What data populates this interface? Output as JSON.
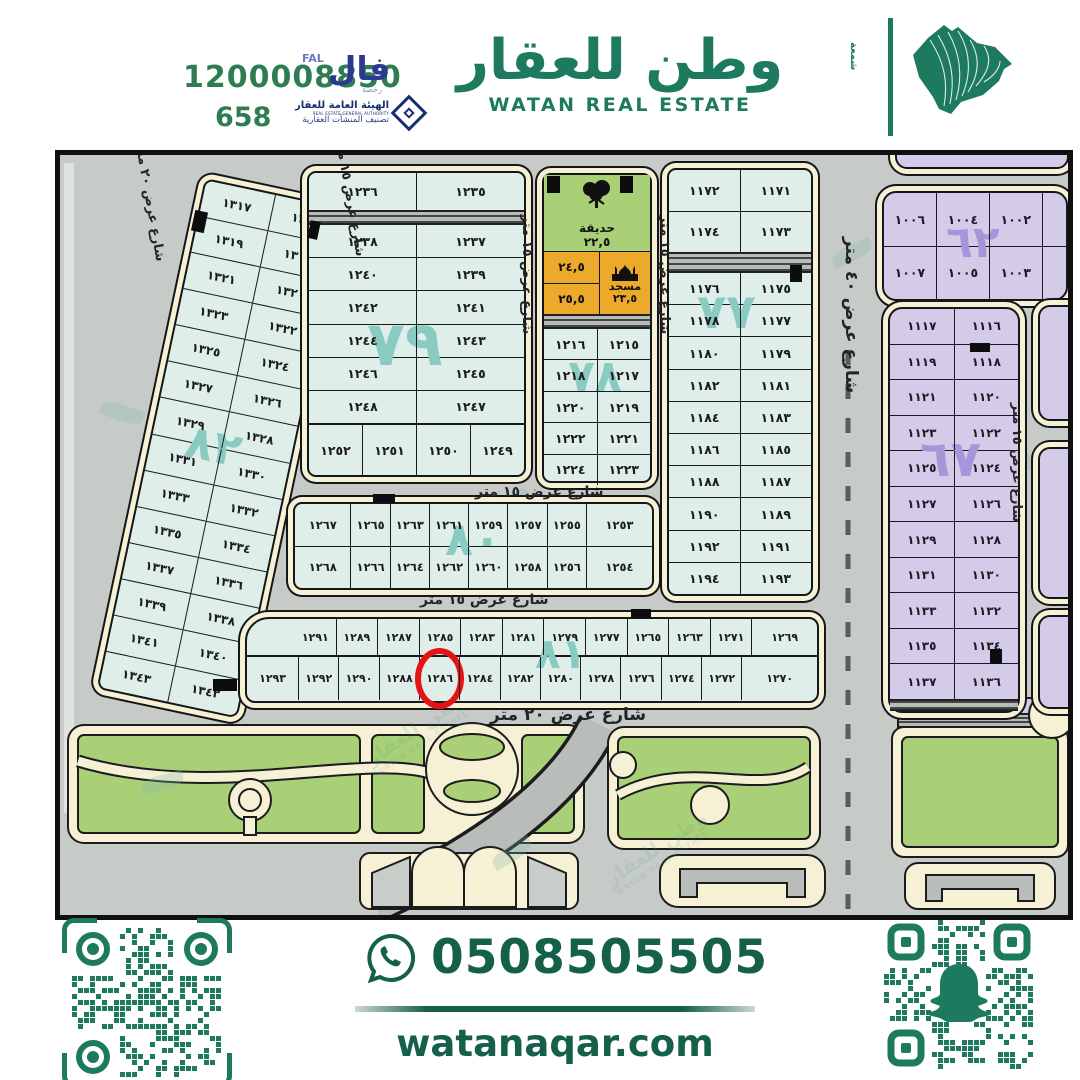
{
  "header": {
    "phone": "1200008850",
    "license_no": "658",
    "fal_ar": "فال",
    "fal_en": "FAL",
    "fal_sub": "رخصة",
    "authority_name_ar": "الهيئة العامة للعقار",
    "authority_name_en": "REAL ESTATE GENERAL AUTHORITY",
    "authority_tagline": "تصنيف المنشآت العقارية",
    "brand_ar": "وطن للعقار",
    "brand_en": "WATAN REAL ESTATE",
    "brand_vertical": "شمعة"
  },
  "map": {
    "street_labels": {
      "w15": "شارع عرض ١٥ متر",
      "w20": "شارع عرض ٢٠ متر",
      "w40": "شارع عرض ٤٠ متر"
    },
    "garden": {
      "name": "حديقة",
      "area": "٢٢,٥"
    },
    "mosque": {
      "name": "مسجد",
      "area": "٢٣,٥"
    },
    "cells_orange": [
      "٢٤,٥",
      "٢٥,٥"
    ],
    "highlighted_plot": "١٢٨٦",
    "blocks": {
      "b82": {
        "label": "٨٢",
        "rows": [
          [
            "١٣١٧",
            "١٣١٦"
          ],
          [
            "١٣١٩",
            "١٣١٨"
          ],
          [
            "١٣٢١",
            "١٣٢٠"
          ],
          [
            "١٣٢٣",
            "١٣٢٢"
          ],
          [
            "١٣٢٥",
            "١٣٢٤"
          ],
          [
            "١٣٢٧",
            "١٣٢٦"
          ],
          [
            "١٣٢٩",
            "١٣٢٨"
          ],
          [
            "١٣٣١",
            "١٣٣٠"
          ],
          [
            "١٣٣٣",
            "١٣٣٢"
          ],
          [
            "١٣٣٥",
            "١٣٣٤"
          ],
          [
            "١٣٣٧",
            "١٣٣٦"
          ],
          [
            "١٣٣٩",
            "١٣٣٨"
          ],
          [
            "١٣٤١",
            "١٣٤٠"
          ],
          [
            "١٣٤٣",
            "١٣٤٢"
          ]
        ]
      },
      "b79": {
        "label": "٧٩",
        "top_rows": [
          [
            "١٢٣٦",
            "١٢٣٥"
          ]
        ],
        "mid_rows": [
          [
            "١٢٣٨",
            "١٢٣٧"
          ],
          [
            "١٢٤٠",
            "١٢٣٩"
          ],
          [
            "١٢٤٢",
            "١٢٤١"
          ],
          [
            "١٢٤٤",
            "١٢٤٣"
          ],
          [
            "١٢٤٦",
            "١٢٤٥"
          ],
          [
            "١٢٤٨",
            "١٢٤٧"
          ]
        ],
        "bottom_rows": [
          [
            "١٢٥٢",
            "١٢٥١",
            "١٢٥٠",
            "١٢٤٩"
          ]
        ]
      },
      "b78": {
        "label": "٧٨",
        "rows": [
          [
            "١٢١٦",
            "١٢١٥"
          ],
          [
            "١٢١٨",
            "١٢١٧"
          ],
          [
            "١٢٢٠",
            "١٢١٩"
          ],
          [
            "١٢٢٢",
            "١٢٢١"
          ],
          [
            "١٢٢٤",
            "١٢٢٣"
          ]
        ]
      },
      "b77": {
        "label": "٧٧",
        "pre_rows": [
          [
            "١١٧٢",
            "١١٧١"
          ],
          [
            "١١٧٤",
            "١١٧٣"
          ]
        ],
        "main_rows": [
          [
            "١١٧٦",
            "١١٧٥"
          ],
          [
            "١١٧٨",
            "١١٧٧"
          ],
          [
            "١١٨٠",
            "١١٧٩"
          ],
          [
            "١١٨٢",
            "١١٨١"
          ],
          [
            "١١٨٤",
            "١١٨٣"
          ],
          [
            "١١٨٦",
            "١١٨٥"
          ],
          [
            "١١٨٨",
            "١١٨٧"
          ],
          [
            "١١٩٠",
            "١١٨٩"
          ],
          [
            "١١٩٢",
            "١١٩١"
          ],
          [
            "١١٩٤",
            "١١٩٣"
          ]
        ]
      },
      "b62": {
        "label": "٦٢",
        "rows": [
          [
            "١٠٠٦",
            "١٠٠٤",
            "١٠٠٢"
          ],
          [
            "١٠٠٧",
            "١٠٠٥",
            "١٠٠٣"
          ]
        ]
      },
      "b67": {
        "label": "٦٧",
        "rows": [
          [
            "١١١٧",
            "١١١٦"
          ],
          [
            "١١١٩",
            "١١١٨"
          ],
          [
            "١١٢١",
            "١١٢٠"
          ],
          [
            "١١٢٣",
            "١١٢٢"
          ],
          [
            "١١٢٥",
            "١١٢٤"
          ],
          [
            "١١٢٧",
            "١١٢٦"
          ],
          [
            "١١٢٩",
            "١١٢٨"
          ],
          [
            "١١٣١",
            "١١٣٠"
          ],
          [
            "١١٣٣",
            "١١٣٢"
          ],
          [
            "١١٣٥",
            "١١٣٤"
          ],
          [
            "١١٣٧",
            "١١٣٦"
          ]
        ]
      },
      "b80": {
        "label": "٨٠",
        "rows": [
          [
            "١٢٦٧",
            "١٢٦٥",
            "١٢٦٣",
            "١٢٦١",
            "١٢٥٩",
            "١٢٥٧",
            "١٢٥٥",
            "١٢٥٣"
          ],
          [
            "١٢٦٨",
            "١٢٦٦",
            "١٢٦٤",
            "١٢٦٢",
            "١٢٦٠",
            "١٢٥٨",
            "١٢٥٦",
            "١٢٥٤"
          ]
        ]
      },
      "b81": {
        "label": "٨١",
        "top_row": [
          [
            "١٢٩١",
            "١٢٨٩",
            "١٢٨٧",
            "١٢٨٥",
            "١٢٨٣",
            "١٢٨١",
            "١٢٧٩",
            "١٢٧٧",
            "١٢٦٥",
            "١٢٦٣",
            "١٢٧١",
            "١٢٦٩"
          ]
        ],
        "bottom_row": [
          [
            "١٢٩٣",
            "١٢٩٢",
            "١٢٩٠",
            "١٢٨٨",
            "١٢٨٦",
            "١٢٨٤",
            "١٢٨٢",
            "١٢٨٠",
            "١٢٧٨",
            "١٢٧٦",
            "١٢٧٤",
            "١٢٧٢",
            "١٢٧٠"
          ]
        ]
      }
    }
  },
  "footer": {
    "whatsapp_number": "0508505505",
    "website": "watanaqar.com"
  },
  "colors": {
    "green": "#1e7a5e",
    "green2": "#2e7d52",
    "greenDark": "#14604a",
    "blue": "#2b3990",
    "tealLabel": "#89cbc0",
    "purpleLabel": "#a795da",
    "plotTeal": "#dfeee9",
    "plotPurple": "#d4cbe9",
    "mapbg": "#c7cbc7",
    "cream": "#f6f0d5",
    "gardenGreen": "#a9d077",
    "orange": "#eca92b",
    "red": "#e41414"
  }
}
